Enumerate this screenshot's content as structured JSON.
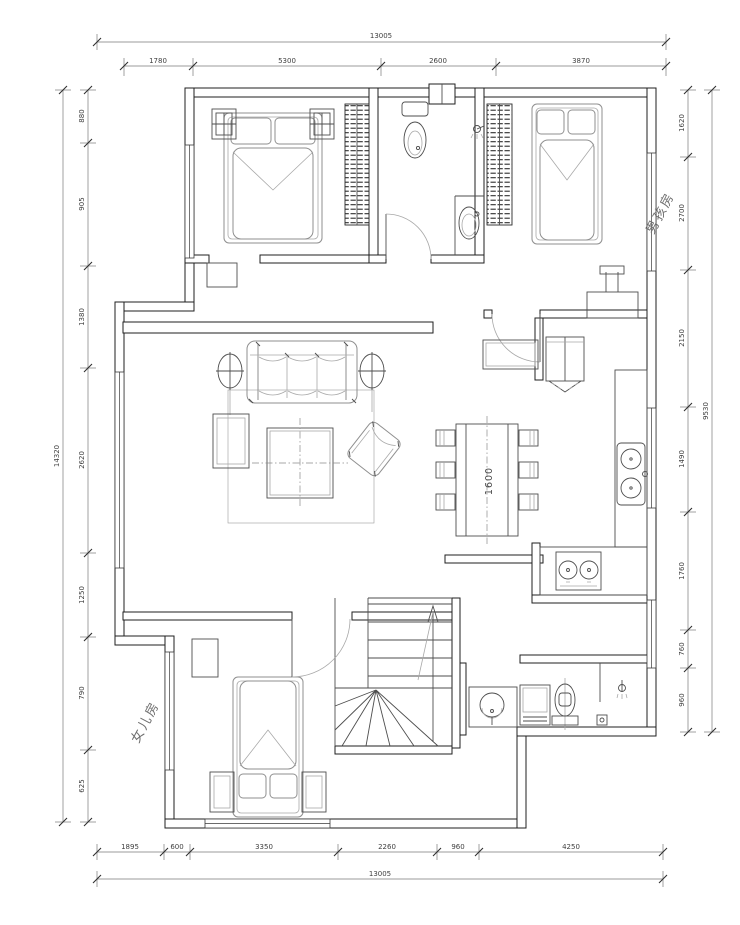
{
  "drawing": {
    "type": "residential floor plan",
    "colors": {
      "walls": "#1f1f1f",
      "furniture": "#8f8f8f",
      "dimensions": "#555555",
      "background": "#ffffff"
    }
  },
  "dimensions": {
    "top": {
      "overall": "13005",
      "chain": [
        "1780",
        "5300",
        "2600",
        "3870"
      ]
    },
    "bottom": {
      "overall": "13005",
      "chain": [
        "1895",
        "600",
        "3350",
        "2260",
        "960",
        "4250"
      ]
    },
    "left": {
      "overall": "14320",
      "chain": [
        "880",
        "905",
        "1380",
        "2620",
        "1250",
        "790",
        "625"
      ]
    },
    "right": {
      "overall": "9530",
      "chain": [
        "1620",
        "2700",
        "2150",
        "1490",
        "1760",
        "760",
        "960"
      ]
    }
  },
  "room_labels": {
    "boys_room": "男孩房",
    "girls_room": "女儿房"
  },
  "furniture_labels": {
    "dining_table_width": "1600"
  }
}
